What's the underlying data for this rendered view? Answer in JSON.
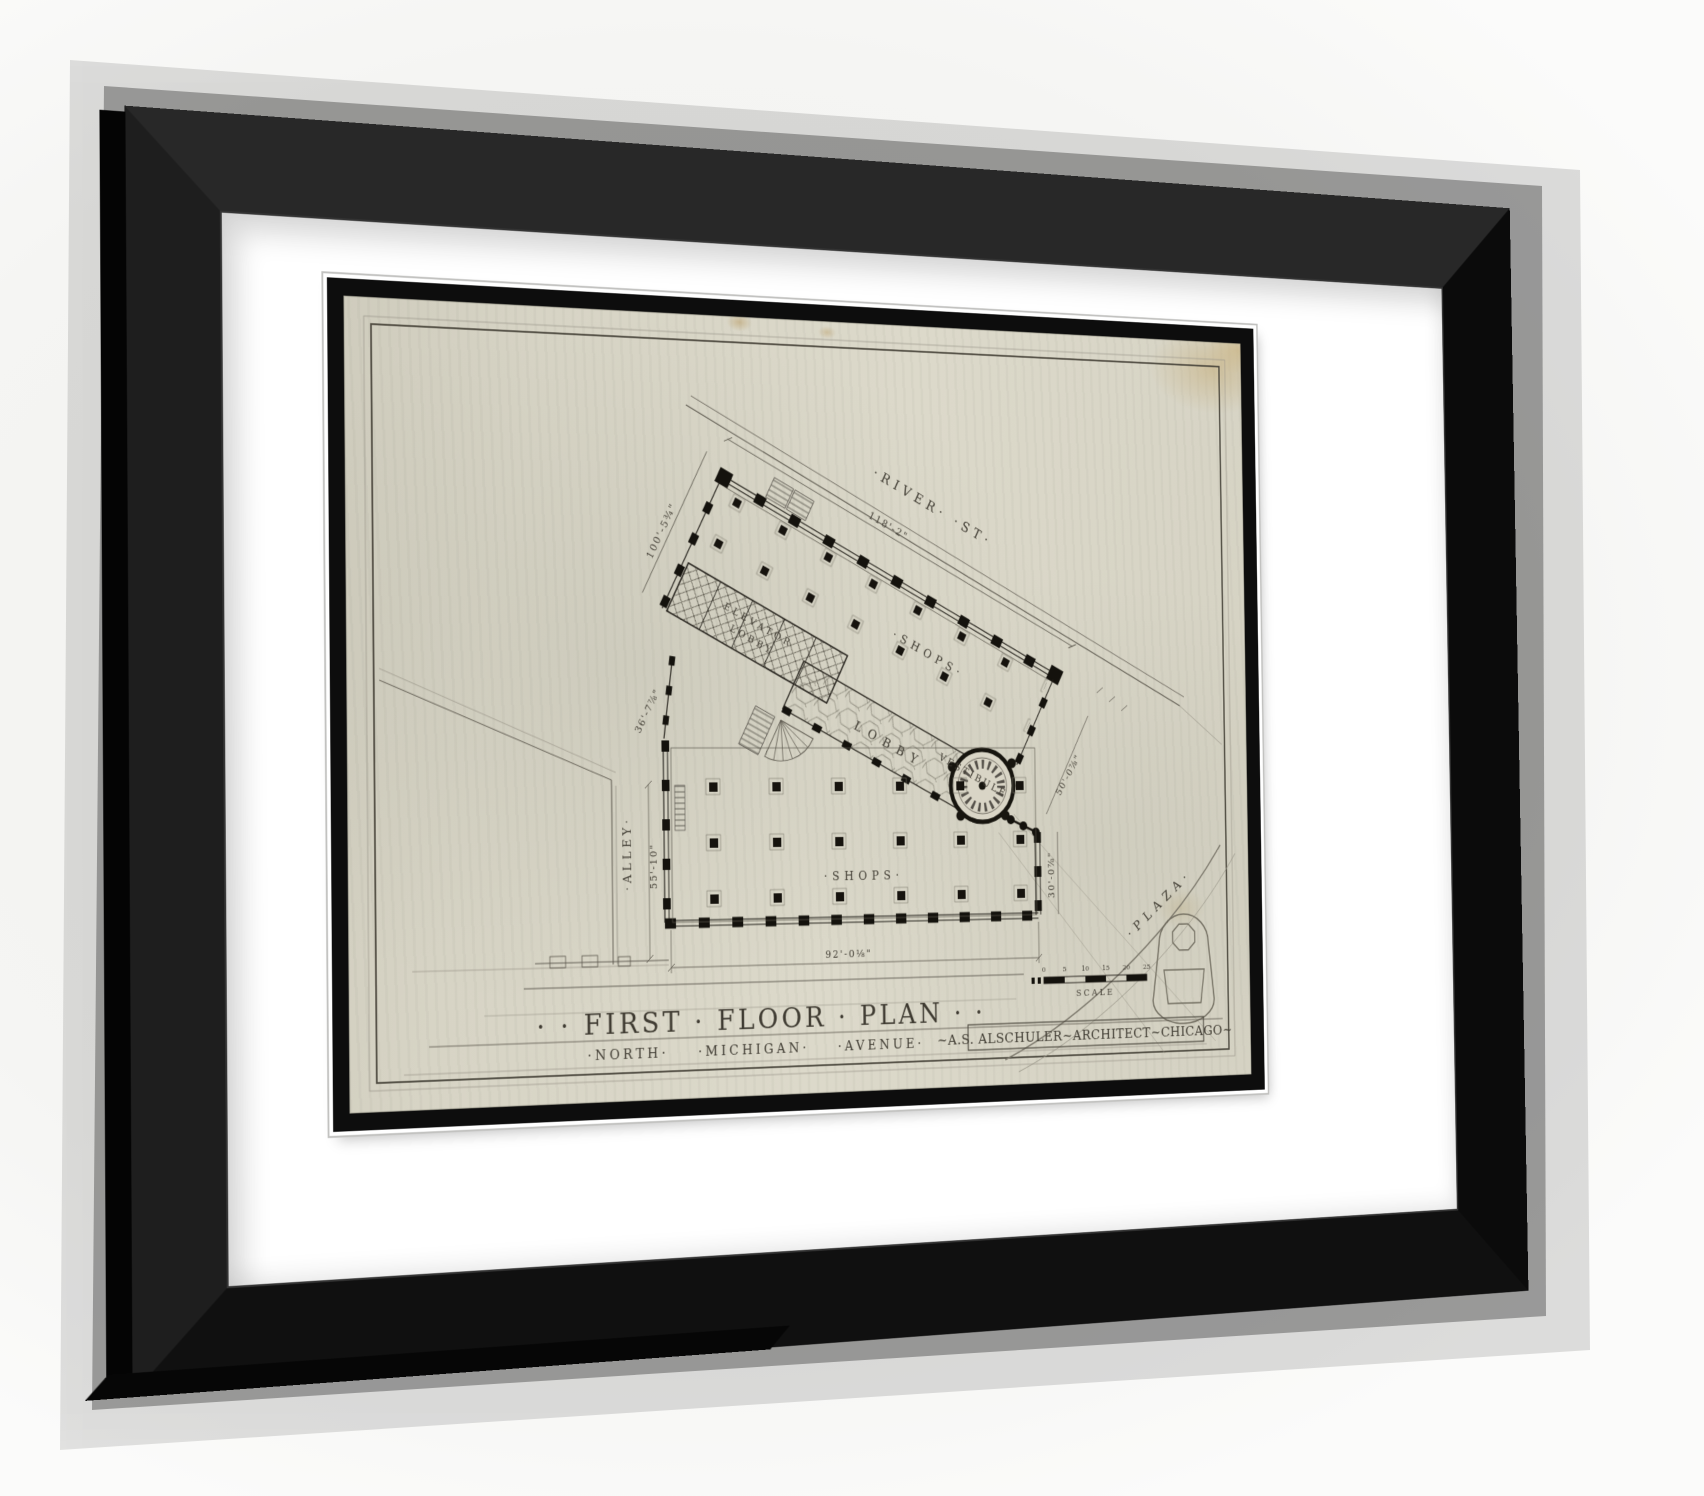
{
  "artwork": {
    "title_line": "· ·  FIRST  ·  FLOOR  ·  PLAN  · ·",
    "street_line": "·NORTH·  ·MICHIGAN·  ·AVENUE·",
    "credit_line": "~A.S. ALSCHULER~ARCHITECT~CHICAGO~",
    "scale_label": "SCALE",
    "scale_ticks": [
      "0",
      "5",
      "10",
      "15",
      "20",
      "25"
    ],
    "labels": {
      "river_st": "·RIVER·  ·ST·",
      "shops_upper": "·SHOPS·",
      "elevator_line1": "ELEVATOR",
      "elevator_line2": "LOBBY",
      "lobby": "LOBBY",
      "vestibule": "VESTIBULE",
      "shops_lower": "·SHOPS·",
      "alley": "·ALLEY·",
      "plaza": "·PLAZA·"
    },
    "dimensions": {
      "river_frontage": "118'-2\"",
      "west_wall": "100'-5¾\"",
      "southwest_wall": "36'-7⅞\"",
      "alley_width": "55'-10\"",
      "south_wall": "92'-0⅛\"",
      "east_wall": "30'-0⅞\"",
      "entrance_front": "50'-0⅞\""
    },
    "colors": {
      "frame": "#0b0b0b",
      "matte": "#ffffff",
      "paper": "#d7d4c5",
      "ink": "#211e18"
    }
  }
}
